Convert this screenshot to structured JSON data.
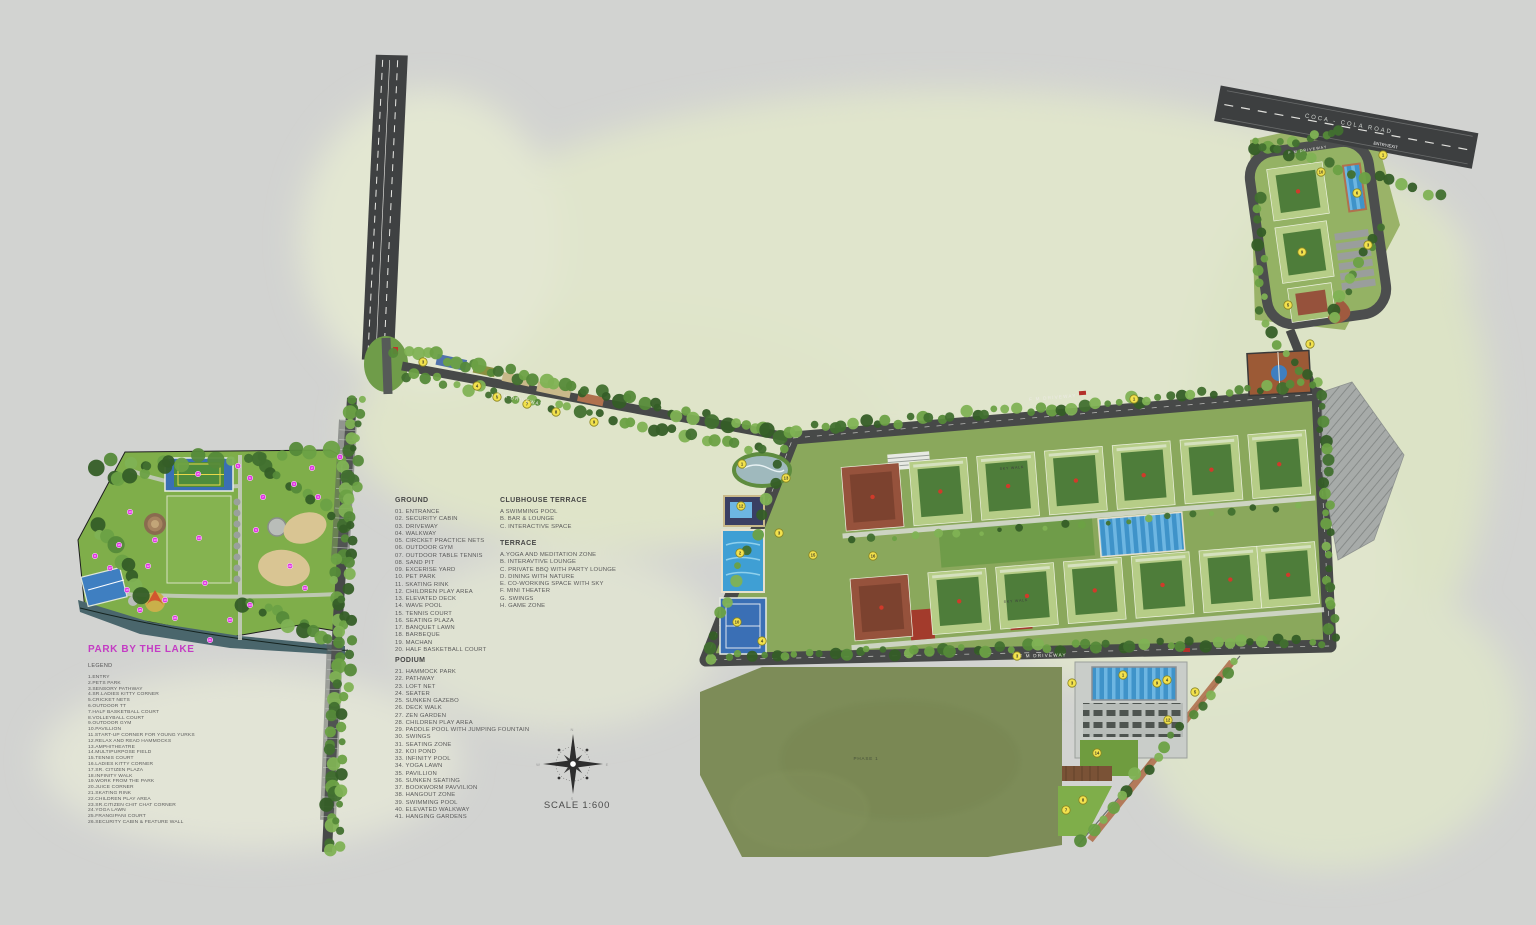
{
  "page": {
    "scale_label": "SCALE 1:600"
  },
  "park_legend": {
    "title": "PARK BY THE LAKE",
    "subtitle": "LEGEND",
    "items": [
      "1.ENTRY",
      "2.PETS PARK",
      "3.SENSORY PATHWAY",
      "4.SR.LADIES KITTY CORNER",
      "5.CRICKET NETS",
      "6.OUTDOOR TT",
      "7.HALF BASKETBALL COURT",
      "8.VOLLEYBALL COURT",
      "9.OUTDOOR GYM",
      "10.PAVILLION",
      "11.START-UP CORNER FOR YOUNG YURKS",
      "12.RELAX AND READ HAMMOCKS",
      "13.AMPHITHEATRE",
      "14.MULTIPURPOSE FIELD",
      "15.TENNIS COURT",
      "16.LADIES KITTY CORNER",
      "17.SR. CITIZEN PLAZA",
      "18.INFINITY WALK",
      "19.WORK FROM THE PARK",
      "20.JUICE CORNER",
      "21.SKATING RINK",
      "22.CHILDREN PLAY AREA",
      "23.SR.CITIZEN CHIT CHAT CORNER",
      "24.YOGA LAWN",
      "25.FRANGIPANI COURT",
      "26.SECURITY CABIN & FEATURE WALL"
    ]
  },
  "ground": {
    "title": "GROUND",
    "items": [
      "01. ENTRANCE",
      "02. SECURITY CABIN",
      "03. DRIVEWAY",
      "04. WALKWAY",
      "05. CIRCKET PRACTICE NETS",
      "06.  OUTDOOR GYM",
      "07. OUTDOOR TABLE TENNIS",
      "08. SAND PIT",
      "09. EXCERISE YARD",
      "10. PET PARK",
      "11. SKATING RINK",
      "12. CHILDREN PLAY AREA",
      "13. ELEVATED DECK",
      "14. WAVE POOL",
      "15. TENNIS COURT",
      "16. SEATING PLAZA",
      "17. BANQUET LAWN",
      "18. BARBEQUE",
      "19. MACHAN",
      "20. HALF BASKETBALL COURT"
    ]
  },
  "clubhouse_terrace": {
    "title": "CLUBHOUSE TERRACE",
    "items": [
      "A SWIMMING POOL",
      "B. BAR & LOUNGE",
      "C. INTERACTIVE SPACE"
    ]
  },
  "terrace": {
    "title": "TERRACE",
    "items": [
      "A.YOGA AND MEDITATION ZONE",
      "B. INTERAVTIVE LOUNGE",
      "C.  PRIVATE BBQ WITH PARTY LOUNGE",
      "D. DINING WITH NATURE",
      "E. CO-WORKING SPACE WITH SKY",
      "F. MINI THEATER",
      "G. SWINGS",
      "H. GAME ZONE"
    ]
  },
  "podium": {
    "title": "PODIUM",
    "items": [
      "21. HAMMOCK PARK",
      "22. PATHWAY",
      "23. LOFT NET",
      "24. SEATER",
      "25. SUNKEN GAZEBO",
      "26. DECK WALK",
      "27. ZEN GARDEN",
      "28. CHILDREN PLAY AREA",
      "29. PADDLE POOL WITH JUMPING FOUNTAIN",
      "30. SWINGS",
      "31. SEATING ZONE",
      "32. KOI POND",
      "33. INFINITY POOL",
      "34. YOGA LAWN",
      "35. PAVILLION",
      "36. SUNKEN SEATING",
      "37. BOOKWORM PAVVILION",
      "38. HANGOUT ZONE",
      "39. SWIMMING POOL",
      "40. ELEVATED WALKWAY",
      "41. HANGING GARDENS"
    ]
  },
  "map_labels": {
    "coca_cola_road": "COCA - COLA ROAD",
    "entry_exit": "ENTRY/EXIT",
    "fm_driveway": "F M DRIVEWAY",
    "sky_walk": "SKY WALK",
    "phase_1": "PHASE 1"
  },
  "compass": {
    "n": "N",
    "e": "E",
    "s": "S",
    "w": "W"
  },
  "colors": {
    "background": "#d2d3d1",
    "wash_green": "#e0e5cc",
    "road": "#474948",
    "park_green": "#7fae4a",
    "olive_field": "#7d8c58",
    "pool_blue": "#3f93c9",
    "lake": "#4a666c",
    "terracotta": "#96523c",
    "roof_green": "#b6cd87",
    "court_green": "#4e7d3a",
    "marker_yellow": "#f2e14d",
    "marker_pink": "#e038e0",
    "title_magenta": "#c43cc4"
  },
  "map_markers": {
    "yellow": [
      {
        "n": "3",
        "x": 423,
        "y": 362
      },
      {
        "n": "4",
        "x": 477,
        "y": 386
      },
      {
        "n": "5",
        "x": 497,
        "y": 397
      },
      {
        "n": "7",
        "x": 527,
        "y": 404
      },
      {
        "n": "8",
        "x": 556,
        "y": 412
      },
      {
        "n": "9",
        "x": 594,
        "y": 422
      },
      {
        "n": "1",
        "x": 742,
        "y": 464
      },
      {
        "n": "12",
        "x": 741,
        "y": 506
      },
      {
        "n": "2",
        "x": 740,
        "y": 553
      },
      {
        "n": "10",
        "x": 737,
        "y": 622
      },
      {
        "n": "4",
        "x": 762,
        "y": 641
      },
      {
        "n": "3",
        "x": 779,
        "y": 533
      },
      {
        "n": "15",
        "x": 813,
        "y": 555
      },
      {
        "n": "16",
        "x": 873,
        "y": 556
      },
      {
        "n": "13",
        "x": 786,
        "y": 478
      },
      {
        "n": "1",
        "x": 1134,
        "y": 399
      },
      {
        "n": "3",
        "x": 1017,
        "y": 656
      },
      {
        "n": "3",
        "x": 1310,
        "y": 344
      },
      {
        "n": "1",
        "x": 1383,
        "y": 155
      },
      {
        "n": "10",
        "x": 1321,
        "y": 172
      },
      {
        "n": "6",
        "x": 1357,
        "y": 193
      },
      {
        "n": "3",
        "x": 1368,
        "y": 245
      },
      {
        "n": "9",
        "x": 1302,
        "y": 252
      },
      {
        "n": "5",
        "x": 1288,
        "y": 305
      },
      {
        "n": "1",
        "x": 1123,
        "y": 675
      },
      {
        "n": "3",
        "x": 1072,
        "y": 683
      },
      {
        "n": "9",
        "x": 1157,
        "y": 683
      },
      {
        "n": "4",
        "x": 1167,
        "y": 680
      },
      {
        "n": "5",
        "x": 1195,
        "y": 692
      },
      {
        "n": "12",
        "x": 1168,
        "y": 720
      },
      {
        "n": "14",
        "x": 1097,
        "y": 753
      },
      {
        "n": "8",
        "x": 1083,
        "y": 800
      },
      {
        "n": "7",
        "x": 1066,
        "y": 810
      }
    ],
    "pink": [
      {
        "n": "1",
        "x": 340,
        "y": 457
      },
      {
        "n": "2",
        "x": 312,
        "y": 468
      },
      {
        "n": "3",
        "x": 294,
        "y": 484
      },
      {
        "n": "4",
        "x": 318,
        "y": 497
      },
      {
        "n": "5",
        "x": 238,
        "y": 466
      },
      {
        "n": "6",
        "x": 250,
        "y": 478
      },
      {
        "n": "7",
        "x": 263,
        "y": 497
      },
      {
        "n": "8",
        "x": 95,
        "y": 556
      },
      {
        "n": "9",
        "x": 256,
        "y": 530
      },
      {
        "n": "10",
        "x": 130,
        "y": 512
      },
      {
        "n": "11",
        "x": 205,
        "y": 583
      },
      {
        "n": "12",
        "x": 148,
        "y": 566
      },
      {
        "n": "13",
        "x": 155,
        "y": 540
      },
      {
        "n": "14",
        "x": 199,
        "y": 538
      },
      {
        "n": "15",
        "x": 198,
        "y": 474
      },
      {
        "n": "16",
        "x": 119,
        "y": 545
      },
      {
        "n": "17",
        "x": 110,
        "y": 568
      },
      {
        "n": "18",
        "x": 127,
        "y": 590
      },
      {
        "n": "19",
        "x": 165,
        "y": 600
      },
      {
        "n": "20",
        "x": 230,
        "y": 620
      },
      {
        "n": "21",
        "x": 210,
        "y": 640
      },
      {
        "n": "22",
        "x": 290,
        "y": 566
      },
      {
        "n": "23",
        "x": 250,
        "y": 605
      },
      {
        "n": "24",
        "x": 305,
        "y": 588
      },
      {
        "n": "25",
        "x": 140,
        "y": 610
      },
      {
        "n": "26",
        "x": 175,
        "y": 618
      }
    ]
  }
}
